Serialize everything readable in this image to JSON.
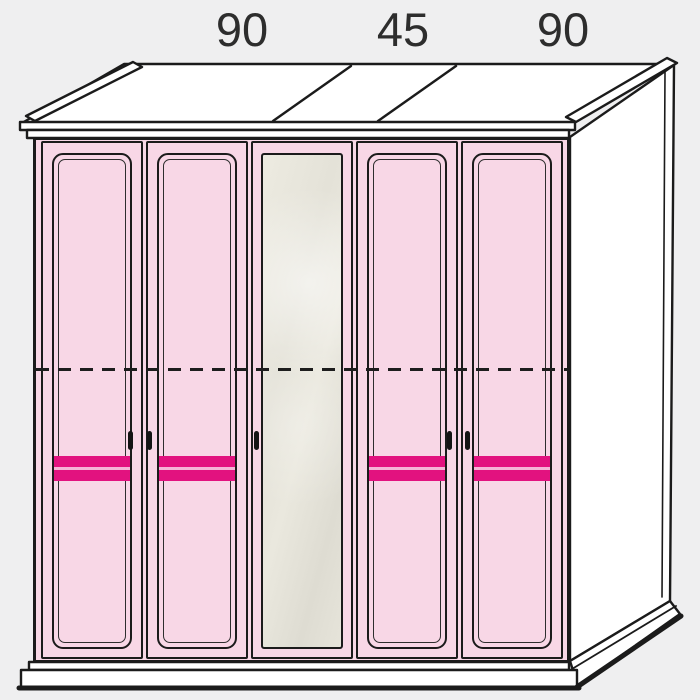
{
  "page": {
    "background": "#efeff0"
  },
  "dimension_labels": [
    {
      "text": "90"
    },
    {
      "text": "45"
    },
    {
      "text": "90"
    }
  ],
  "wardrobe": {
    "modules": [
      {
        "width_label": "90",
        "doors": [
          "door-1",
          "door-2"
        ]
      },
      {
        "width_label": "45",
        "doors": [
          "door-3"
        ]
      },
      {
        "width_label": "90",
        "doors": [
          "door-4",
          "door-5"
        ]
      }
    ],
    "doors": [
      {
        "id": "door-1",
        "style": "pink-panel",
        "stripes": 2,
        "handle_side": "right"
      },
      {
        "id": "door-2",
        "style": "pink-panel",
        "stripes": 2,
        "handle_side": "left"
      },
      {
        "id": "door-3",
        "style": "mirror",
        "stripes": 0,
        "handle_side": "left"
      },
      {
        "id": "door-4",
        "style": "pink-panel",
        "stripes": 2,
        "handle_side": "right"
      },
      {
        "id": "door-5",
        "style": "pink-panel",
        "stripes": 2,
        "handle_side": "left"
      }
    ],
    "internal_divider": "horizontal-dashed-line"
  },
  "colors": {
    "background": "#efeff0",
    "outline": "#1b1b1b",
    "door_pink": "#f8d7e6",
    "stripe": "#e2127f",
    "stripe_gap": "#f5b5d6",
    "mirror_gray": "#e6e4da",
    "white": "#ffffff",
    "label_text": "#2d2d2d"
  }
}
